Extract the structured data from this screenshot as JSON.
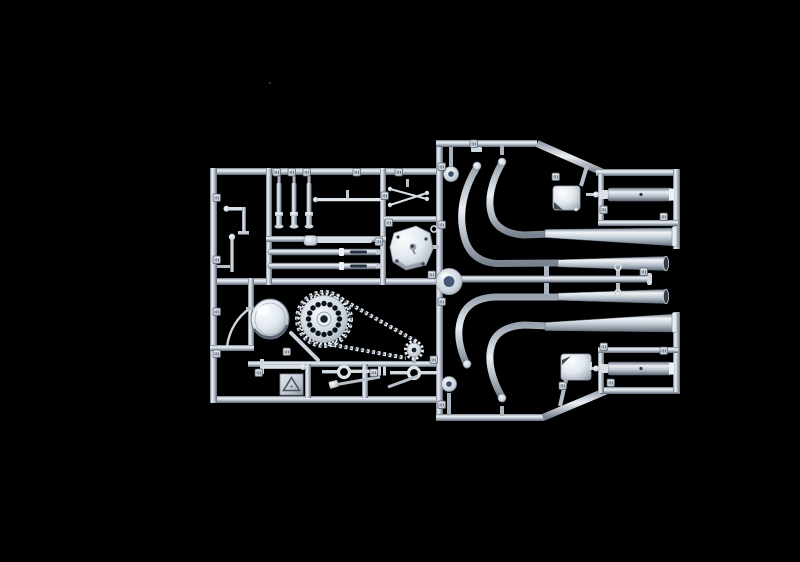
{
  "scene": {
    "title": "Photograph of a silver-grey plastic model kit sprue (motorcycle parts tree) on a black background",
    "subject": "plastic model kit sprue",
    "description": "Injection-moulded runner frame holding unassembled classic-motorcycle parts: fork tubes, linkage rods, engine side cover, headlamp shell, drilled rear sprocket with moulded drive chain, stands and levers, four swept exhaust header pipes with megaphone silencers, two shock-absorber cylinders, carburettor bodies and small part-number pads"
  },
  "colors": {
    "background": "#000000",
    "plastic_highlight": "#f2f6fa",
    "plastic_light": "#dde4ec",
    "plastic_mid": "#b6c0ca",
    "plastic_shade": "#7d8794",
    "plastic_dark": "#4e5864",
    "hole_dark": "#1a2029",
    "slot_dark": "#27303d",
    "steering_ring_center": "#46587a",
    "hub_center_blue": "#3d4f6d",
    "mouth_dark": "#333b47"
  },
  "parts": [
    {
      "name": "sprue-frame",
      "description": "Rectangular runner frame with internal divider runners"
    },
    {
      "name": "fork-slider-tubes",
      "description": "Three short vertical fork slider tubes"
    },
    {
      "name": "fork-stanchion-tubes",
      "description": "Two long telescopic fork tubes with dark slots"
    },
    {
      "name": "linkage-rods",
      "description": "Thin control rods, cranks and ball-ended levers"
    },
    {
      "name": "engine-side-cover",
      "description": "Bright white engine crankcase side cover with bolt holes"
    },
    {
      "name": "headlamp-shell",
      "description": "Hemispherical headlamp bowl"
    },
    {
      "name": "rear-sprocket",
      "description": "Large drilled rear sprocket ringed by moulded chain"
    },
    {
      "name": "drive-chain",
      "description": "Moulded chain loop running to small front sprocket"
    },
    {
      "name": "front-sprocket",
      "description": "Small toothed front sprocket"
    },
    {
      "name": "stand-levers",
      "description": "Ring-eyed stand and brake levers with diagonal struts"
    },
    {
      "name": "recycling-plate",
      "description": "Square pad embossed with recycling triangle"
    },
    {
      "name": "exhaust-header-pipes",
      "description": "Four swept exhaust header pipes with port collars"
    },
    {
      "name": "megaphone-silencers",
      "description": "Tapered megaphone exhaust silencers"
    },
    {
      "name": "shock-absorber-cylinders",
      "description": "Two cylindrical damper bodies inside sub-frames"
    },
    {
      "name": "carburettor-bodies",
      "description": "Two small bright carburettor/float-bowl boxes"
    },
    {
      "name": "steering-head-ring",
      "description": "Round bearing ring moulded at centre runner junction"
    },
    {
      "name": "hub-discs",
      "description": "Small hub discs with dark blue centres"
    },
    {
      "name": "part-number-tags",
      "description": "Small embossed part-number pads on the runners"
    }
  ]
}
